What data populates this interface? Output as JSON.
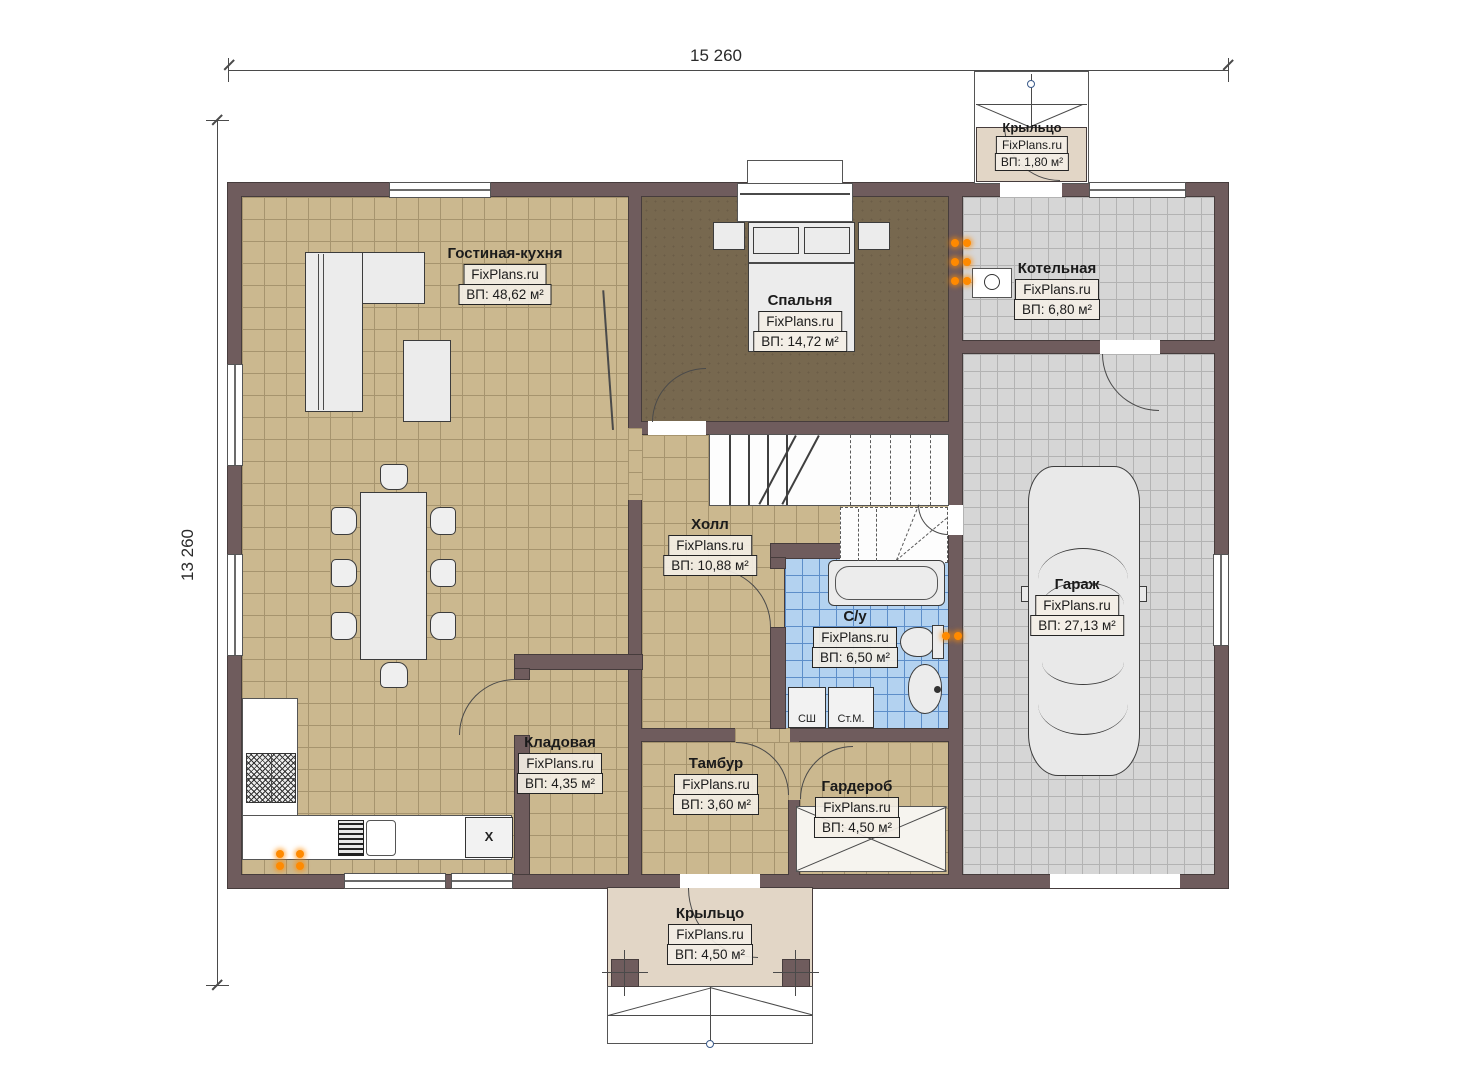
{
  "watermark": "FixPlans.ru",
  "dimensions": {
    "width_label": "15 260",
    "height_label": "13 260"
  },
  "rooms": [
    {
      "id": "living_kitchen",
      "name": "Гостиная-кухня",
      "area": "ВП: 48,62 м²"
    },
    {
      "id": "bedroom",
      "name": "Спальня",
      "area": "ВП: 14,72 м²"
    },
    {
      "id": "boiler",
      "name": "Котельная",
      "area": "ВП: 6,80 м²"
    },
    {
      "id": "hall",
      "name": "Холл",
      "area": "ВП: 10,88 м²"
    },
    {
      "id": "bathroom",
      "name": "С/у",
      "area": "ВП: 6,50 м²"
    },
    {
      "id": "garage",
      "name": "Гараж",
      "area": "ВП: 27,13 м²"
    },
    {
      "id": "storage",
      "name": "Кладовая",
      "area": "ВП: 4,35 м²"
    },
    {
      "id": "vestibule",
      "name": "Тамбур",
      "area": "ВП: 3,60 м²"
    },
    {
      "id": "wardrobe",
      "name": "Гардероб",
      "area": "ВП: 4,50 м²"
    },
    {
      "id": "porch_top",
      "name": "Крыльцо",
      "area": "ВП: 1,80 м²"
    },
    {
      "id": "porch_bottom",
      "name": "Крыльцо",
      "area": "ВП: 4,50 м²"
    }
  ],
  "appliances": {
    "dryer": "СШ",
    "washer": "Ст.М.",
    "dishwasher_mark": "X"
  },
  "colors": {
    "wall": "#6f5c5d",
    "line": "#463c3c",
    "beige": "#cbb88f",
    "beige-grid": "#a6946e",
    "gray": "#d6d6d6",
    "gray-grid": "#b3b3b3",
    "blue": "#b3d2f0",
    "blue-grid": "#5d8ec9",
    "bedroomf": "#77684f",
    "porchf": "#e2d6c6",
    "furn": "#ececec",
    "rad": "#ff8a00"
  }
}
